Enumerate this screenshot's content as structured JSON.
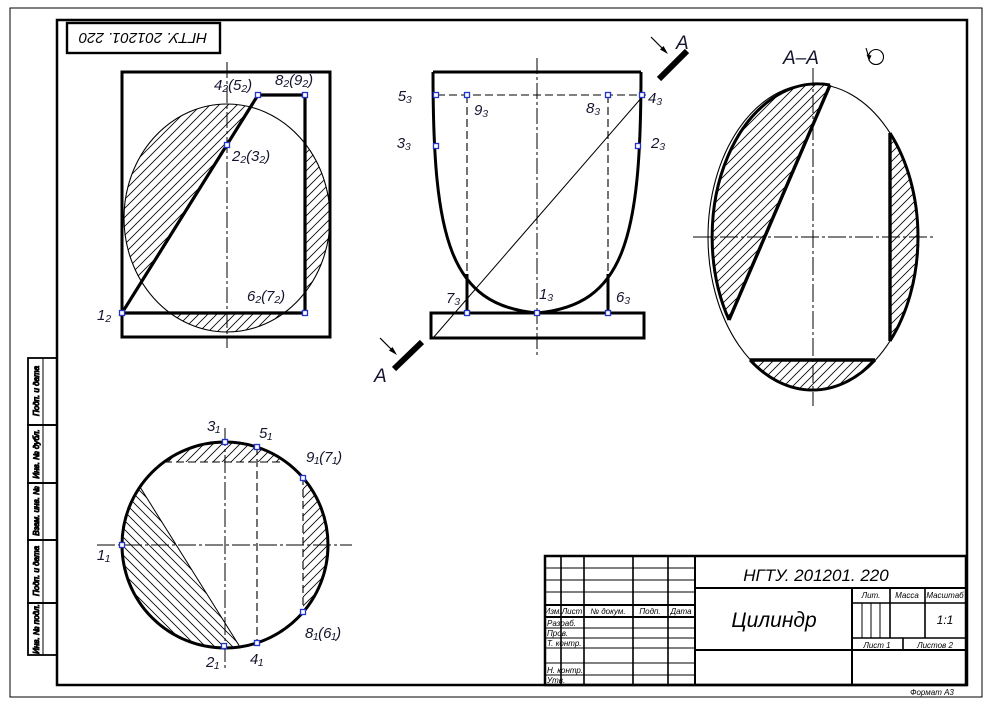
{
  "sheet": {
    "top_stamp": "НГТУ. 201201. 220",
    "format_note": "Формат А3",
    "side_boxes": [
      "Подп. и дата",
      "Инв. № дубл.",
      "Взам. инв. №",
      "Подп. и дата",
      "Инв. № подл."
    ]
  },
  "views": {
    "frontal": {
      "p45": "4₂(5₂)",
      "p89": "8₂(9₂)",
      "p23": "2₂(3₂)",
      "p67": "6₂(7₂)",
      "p1": "1₂"
    },
    "profile": {
      "p5": "5₃",
      "p9": "9₃",
      "p8": "8₃",
      "p4": "4₃",
      "p3": "3₃",
      "p2": "2₃",
      "p7": "7₃",
      "p1": "1₃",
      "p6": "6₃"
    },
    "horizontal": {
      "p3": "3₁",
      "p5": "5₁",
      "p97": "9₁(7₁)",
      "p1": "1₁",
      "p86": "8₁(6₁)",
      "p2": "2₁",
      "p4": "4₁"
    },
    "section": {
      "title": "А–А"
    },
    "cut_letter": "А"
  },
  "title_block": {
    "doc_number": "НГТУ. 201201. 220",
    "part_name": "Цилиндр",
    "scale": "1:1",
    "headers": {
      "izm": "Изм.",
      "list": "Лист",
      "doc": "№ докум.",
      "podp": "Подп.",
      "data": "Дата",
      "lit": "Лит.",
      "massa": "Масса",
      "masshtab": "Масштаб"
    },
    "rows": {
      "razrab": "Разраб.",
      "prov": "Пров.",
      "tkontr": "Т. контр.",
      "nkontr": "Н. контр.",
      "utv": "Утв."
    },
    "sheet_info": {
      "list": "Лист 1",
      "listov": "Листов 2"
    }
  }
}
